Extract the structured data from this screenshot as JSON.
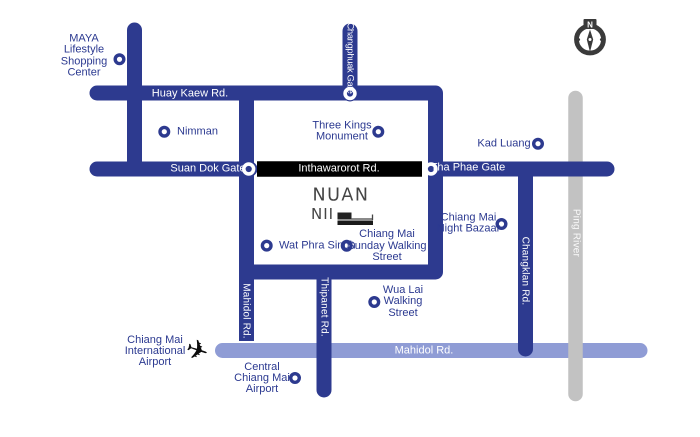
{
  "title": "Chiang Mai access map",
  "colors": {
    "road_blue": "#2d3a8f",
    "road_light_blue": "#8f9cd5",
    "river_gray": "#c2c2c2",
    "road_black": "#000000",
    "label_blue": "#2b3990",
    "compass_dark": "#3a3a3a"
  },
  "roads": {
    "huay_kaew": "Huay Kaew Rd.",
    "suan_dok_gate": "Suan Dok Gate",
    "inthawarorot": "Inthawarorot Rd.",
    "tha_phae_gate": "Tha Phae Gate",
    "changphuak_gate": "Changphuak Gate",
    "changklan": "Changklan Rd.",
    "thipanet": "Thipanet Rd.",
    "mahidol_vertical": "Mahidol Rd.",
    "mahidol_horizontal": "Mahidol Rd.",
    "ping_river": "Ping River"
  },
  "pois": {
    "maya": "MAYA\nLifestyle\nShopping\nCenter",
    "nimman": "Nimman",
    "three_kings": "Three Kings\nMonument",
    "kad_luang": "Kad Luang",
    "wat_phra_singh": "Wat Phra Singh",
    "sunday_walking_street": "Chiang Mai\nSunday Walking\nStreet",
    "night_bazaar": "Chiang Mai\nNight Bazaar",
    "wua_lai": "Wua Lai\nWalking\nStreet",
    "central_airport": "Central\nChiang Mai\nAirport",
    "international_airport": "Chiang Mai\nInternational\nAirport"
  },
  "logo": {
    "line1": "NUAN",
    "line2": "NII"
  },
  "compass": {
    "north_label": "N"
  },
  "icons": {
    "airplane": "✈"
  }
}
